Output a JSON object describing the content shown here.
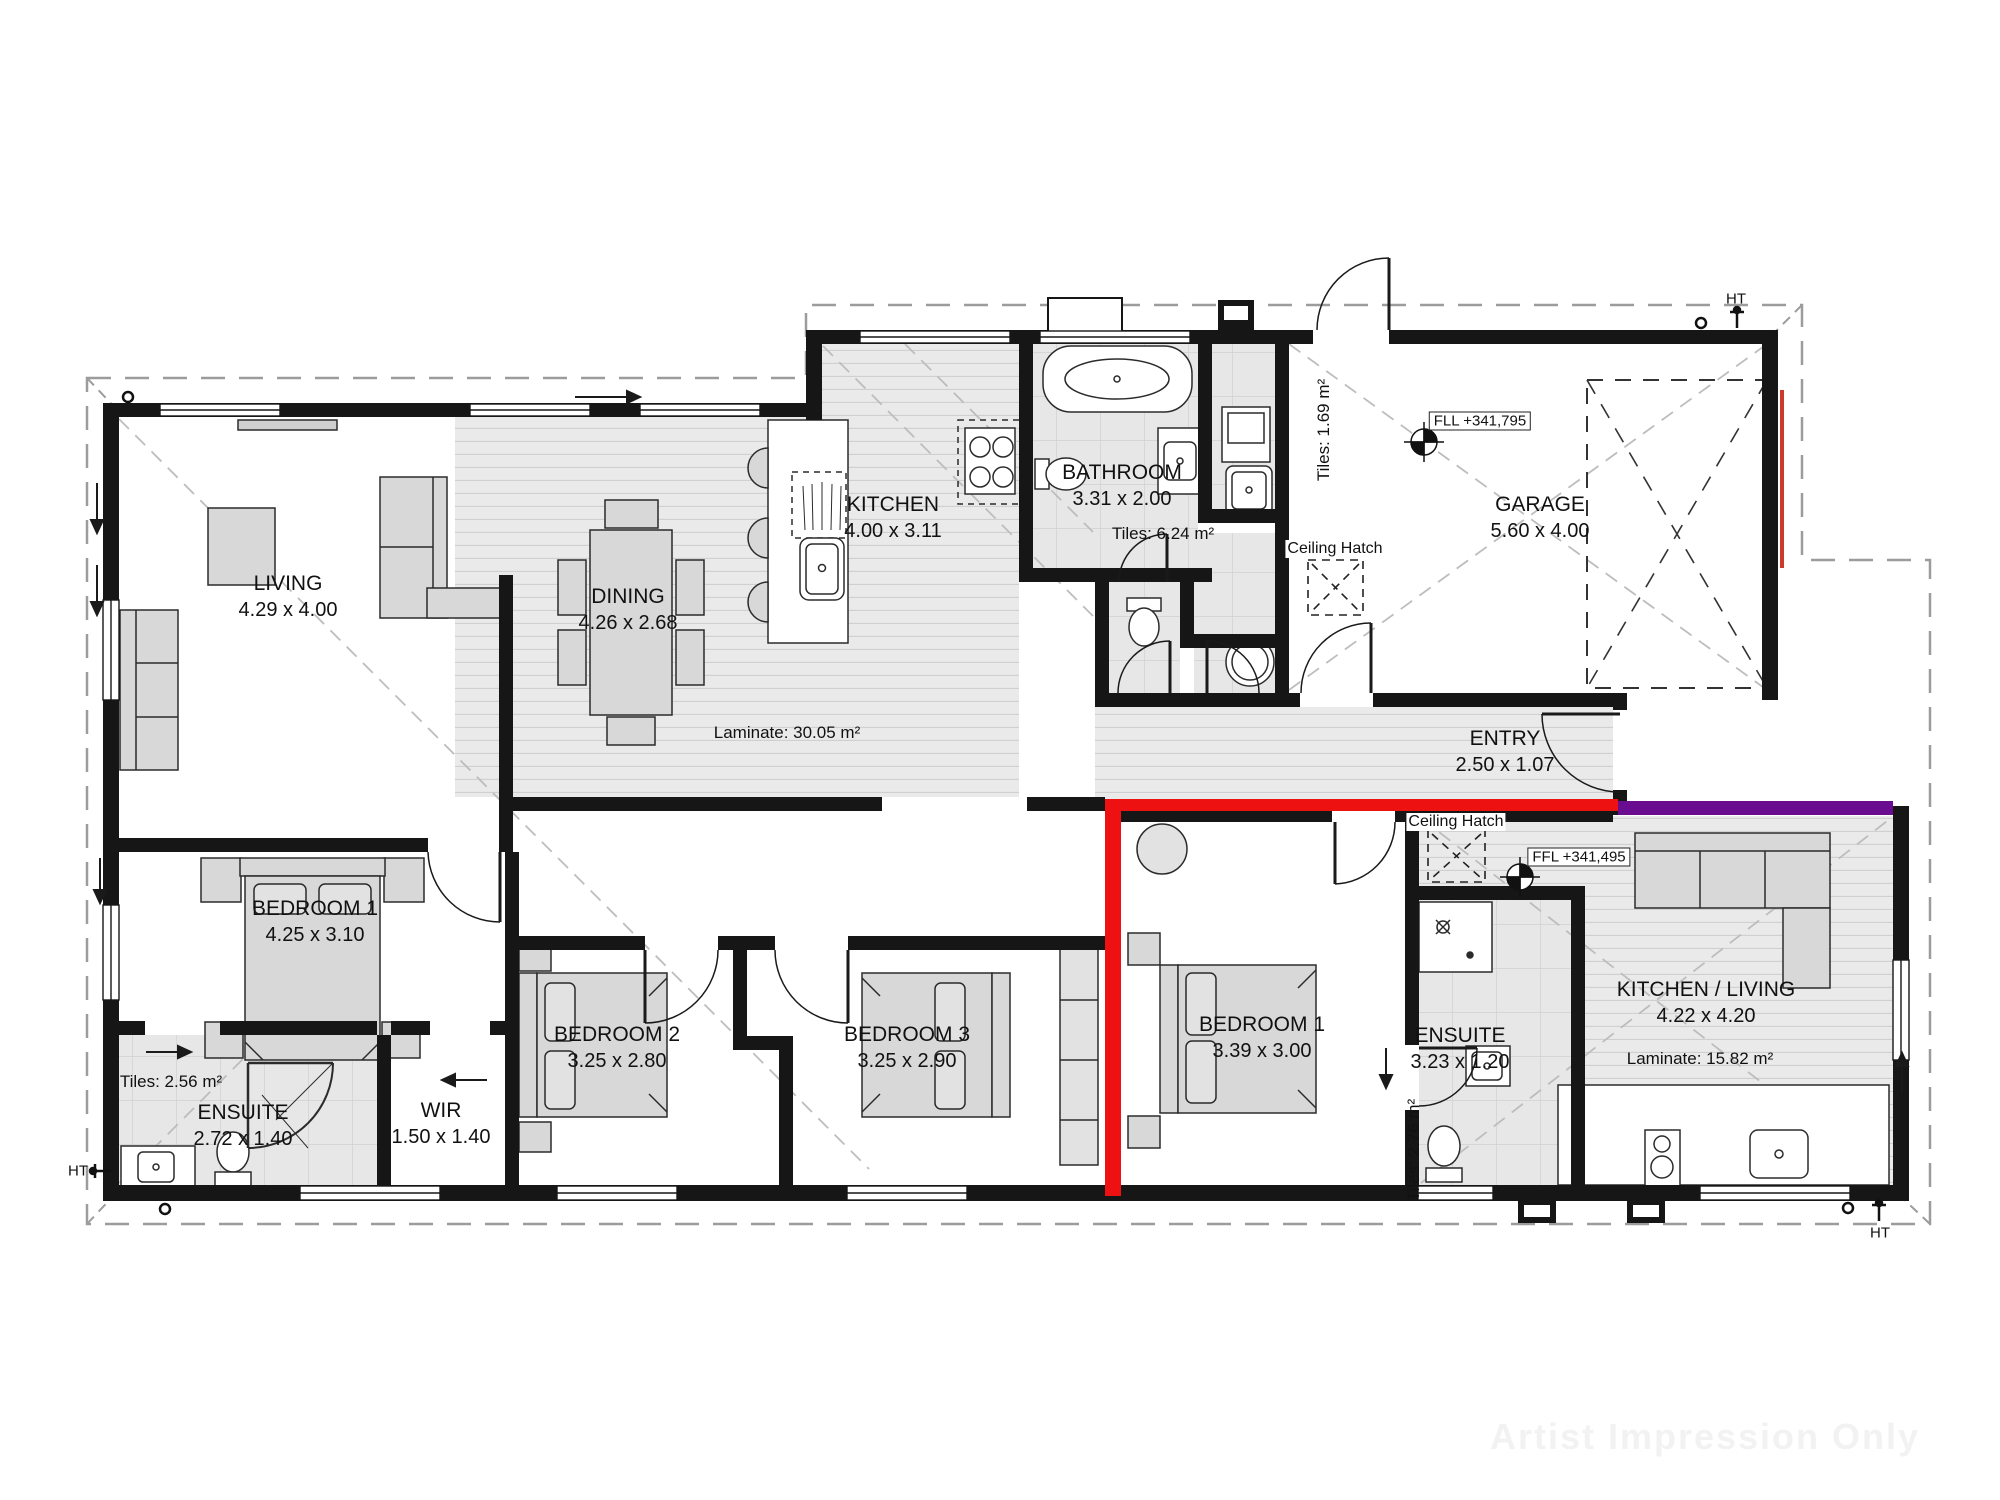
{
  "watermark": "Artist Impression Only",
  "rooms": [
    {
      "id": "living",
      "name": "LIVING",
      "dims": "4.29 x 4.00"
    },
    {
      "id": "dining",
      "name": "DINING",
      "dims": "4.26 x 2.68"
    },
    {
      "id": "kitchen",
      "name": "KITCHEN",
      "dims": "4.00 x 3.11"
    },
    {
      "id": "bathroom",
      "name": "BATHROOM",
      "dims": "3.31 x 2.00"
    },
    {
      "id": "garage",
      "name": "GARAGE",
      "dims": "5.60 x 4.00"
    },
    {
      "id": "entry",
      "name": "ENTRY",
      "dims": "2.50 x 1.07"
    },
    {
      "id": "bedroom1-main",
      "name": "BEDROOM 1",
      "dims": "4.25 x 3.10"
    },
    {
      "id": "ensuite-main",
      "name": "ENSUITE",
      "dims": "2.72 x 1.40"
    },
    {
      "id": "wir",
      "name": "WIR",
      "dims": "1.50 x 1.40"
    },
    {
      "id": "bedroom2",
      "name": "BEDROOM 2",
      "dims": "3.25 x 2.80"
    },
    {
      "id": "bedroom3",
      "name": "BEDROOM 3",
      "dims": "3.25 x 2.90"
    },
    {
      "id": "bedroom1-flat",
      "name": "BEDROOM 1",
      "dims": "3.39 x 3.00"
    },
    {
      "id": "ensuite-flat",
      "name": "ENSUITE",
      "dims": "3.23 x 1.20"
    },
    {
      "id": "kitchen-living-flat",
      "name": "KITCHEN / LIVING",
      "dims": "4.22 x 4.20"
    }
  ],
  "floor_areas": {
    "laminate_main": "Laminate: 30.05 m²",
    "laminate_flat": "Laminate: 15.82 m²",
    "tiles_bathroom": "Tiles: 6.24 m²",
    "tiles_laundry": "Tiles: 1.69 m²",
    "tiles_ensuite_main": "Tiles: 2.56 m²",
    "tiles_ensuite_flat": "Tiles: 2.76 m²"
  },
  "levels": {
    "garage": "FLL +341,795",
    "flat": "FFL +341,495"
  },
  "annotations": {
    "ceiling_hatch": "Ceiling Hatch",
    "hose_tap": "HT"
  },
  "colors": {
    "wall": "#161616",
    "fire_wall_red": "#ee1111",
    "party_wall_purple": "#6a0c8f",
    "garage_door_red": "#cc3b2a",
    "laminate": "#eaeaea",
    "tile": "#e7e7e7",
    "furniture": "#d8d8d8",
    "roofline": "#9c9c9c"
  }
}
